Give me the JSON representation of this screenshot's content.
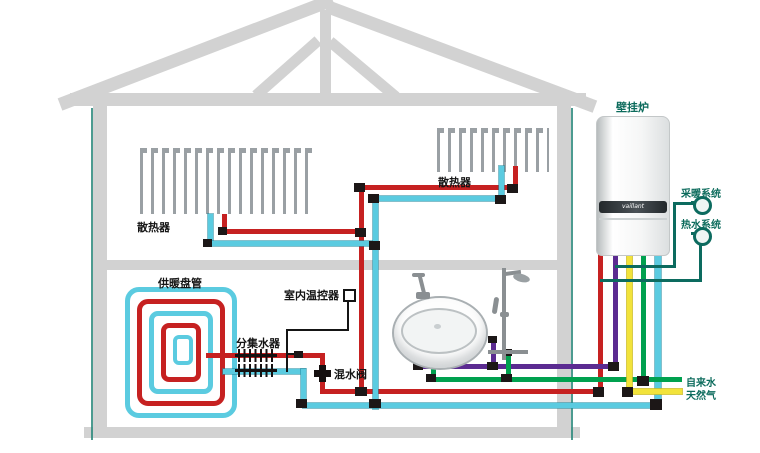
{
  "diagram": {
    "title_context": "home heating and plumbing system schematic",
    "labels": {
      "boiler": "壁挂炉",
      "heating_system": "采暖系统",
      "hot_water_system": "热水系统",
      "tap_water": "自来水",
      "natural_gas": "天然气",
      "radiator_left": "散热器",
      "radiator_right": "散热器",
      "floor_coil": "供暖盘管",
      "manifold": "分集水器",
      "room_thermostat": "室内温控器",
      "mixing_valve": "混水阀",
      "boiler_brand": "vaillant"
    },
    "colors": {
      "heating_supply": "#c62121",
      "heating_return": "#5bcbe0",
      "hot_water": "#5b2b91",
      "tap_water": "#00a14f",
      "natural_gas": "#f2e33b",
      "system_line": "#0c6b5f",
      "structure": "#d2d2d2"
    }
  }
}
